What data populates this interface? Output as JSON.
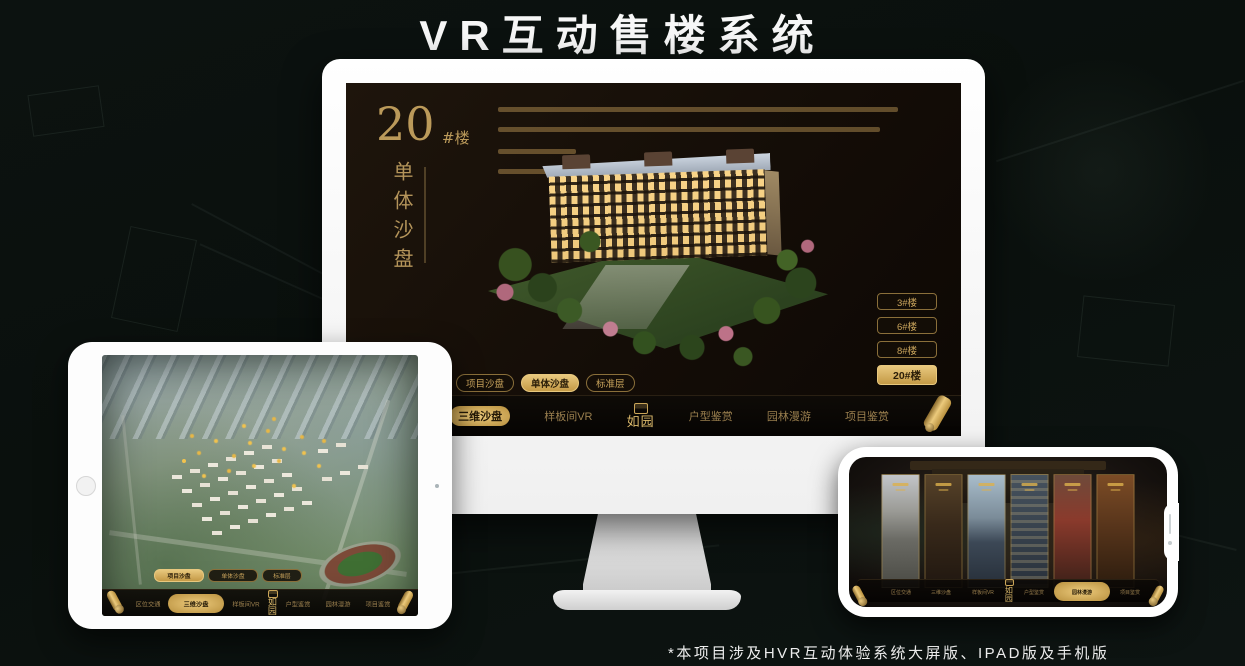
{
  "header": {
    "title": "VR互动售楼系统"
  },
  "footer": {
    "note": "*本项目涉及HVR互动体验系统大屏版、IPAD版及手机版"
  },
  "colors": {
    "gold": "#c9a45c",
    "gold_bright": "#e8c87e",
    "screen_bg": "#140d07"
  },
  "desktop": {
    "unit_number": "20",
    "unit_suffix": "#楼",
    "unit_title_vertical": "单体沙盘",
    "floor_buttons": [
      {
        "label": "3#楼",
        "active": false
      },
      {
        "label": "6#楼",
        "active": false
      },
      {
        "label": "8#楼",
        "active": false
      },
      {
        "label": "20#楼",
        "active": true
      }
    ],
    "tabs": [
      {
        "label": "项目沙盘",
        "active": false
      },
      {
        "label": "单体沙盘",
        "active": true
      },
      {
        "label": "标准层",
        "active": false
      }
    ],
    "nav_items": [
      {
        "label": "区位交通",
        "active": false
      },
      {
        "label": "三维沙盘",
        "active": true
      },
      {
        "label": "样板间VR",
        "active": false
      },
      {
        "label": "户型鉴赏",
        "active": false
      },
      {
        "label": "园林漫游",
        "active": false
      },
      {
        "label": "项目鉴赏",
        "active": false
      }
    ],
    "logo_text": "如园"
  },
  "ipad": {
    "tabs": [
      {
        "label": "项目沙盘",
        "active": true
      },
      {
        "label": "单体沙盘",
        "active": false
      },
      {
        "label": "标准层",
        "active": false
      }
    ],
    "nav_items": [
      {
        "label": "区位交通",
        "active": false
      },
      {
        "label": "三维沙盘",
        "active": true
      },
      {
        "label": "样板间VR",
        "active": false
      },
      {
        "label": "户型鉴赏",
        "active": false
      },
      {
        "label": "园林漫游",
        "active": false
      },
      {
        "label": "项目鉴赏",
        "active": false
      }
    ],
    "logo_text": "如园"
  },
  "phone": {
    "nav_items": [
      {
        "label": "区位交通",
        "active": false
      },
      {
        "label": "三维沙盘",
        "active": false
      },
      {
        "label": "样板间VR",
        "active": false
      },
      {
        "label": "户型鉴赏",
        "active": false
      },
      {
        "label": "园林漫游",
        "active": true
      },
      {
        "label": "项目鉴赏",
        "active": false
      }
    ],
    "logo_text": "如园"
  }
}
